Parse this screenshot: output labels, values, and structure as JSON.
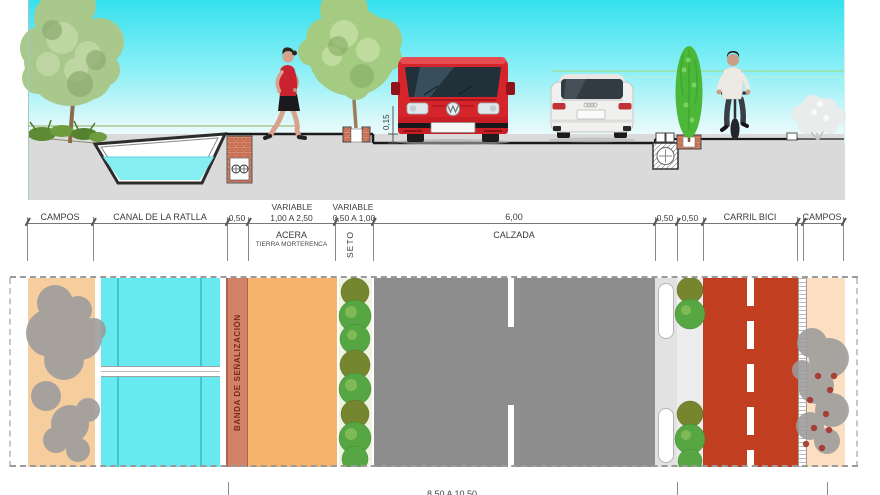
{
  "section_view": {
    "curb_height": "0,15"
  },
  "dimension_band": {
    "variable_top_left": "VARIABLE",
    "variable_top_right": "VARIABLE",
    "campos_left": "CAMPOS",
    "canal": "CANAL DE LA RATLLA",
    "gap_050": "0,50",
    "acera_range": "1,00 A 2,50",
    "seto_range": "0,50 A 1,00",
    "calzada_width": "6,00",
    "strip_050_a": "0,50",
    "strip_050_b": "0,50",
    "carril_bici": "CARRIL BICI",
    "campos_right": "CAMPOS",
    "acera_label": "ACERA",
    "acera_material": "TIERRA MORTERENCA",
    "seto_label": "SETO",
    "calzada_label": "CALZADA"
  },
  "plan_view": {
    "banda_label": "BANDA DE SEÑALIZACIÓN"
  },
  "bottom_dimension": {
    "total_range": "8,50 A 10,50"
  },
  "colors": {
    "sky": "#35e1ee",
    "water": "#86edf1",
    "ground": "#dadada",
    "brick": "#c46a4f",
    "campos_plan": "#f6cd9d",
    "campos_plan_right": "#fbdfc0",
    "canal_plan": "#67e9f0",
    "banda": "#d08366",
    "acera_plan": "#f6b46b",
    "calzada_plan": "#8d8d8d",
    "carril_bici_plan": "#c23e20",
    "hedge_green": "#56a743",
    "hedge_olive": "#76862f",
    "van_red": "#d6242b",
    "tree_plan_gray": "#9c9c9c"
  }
}
